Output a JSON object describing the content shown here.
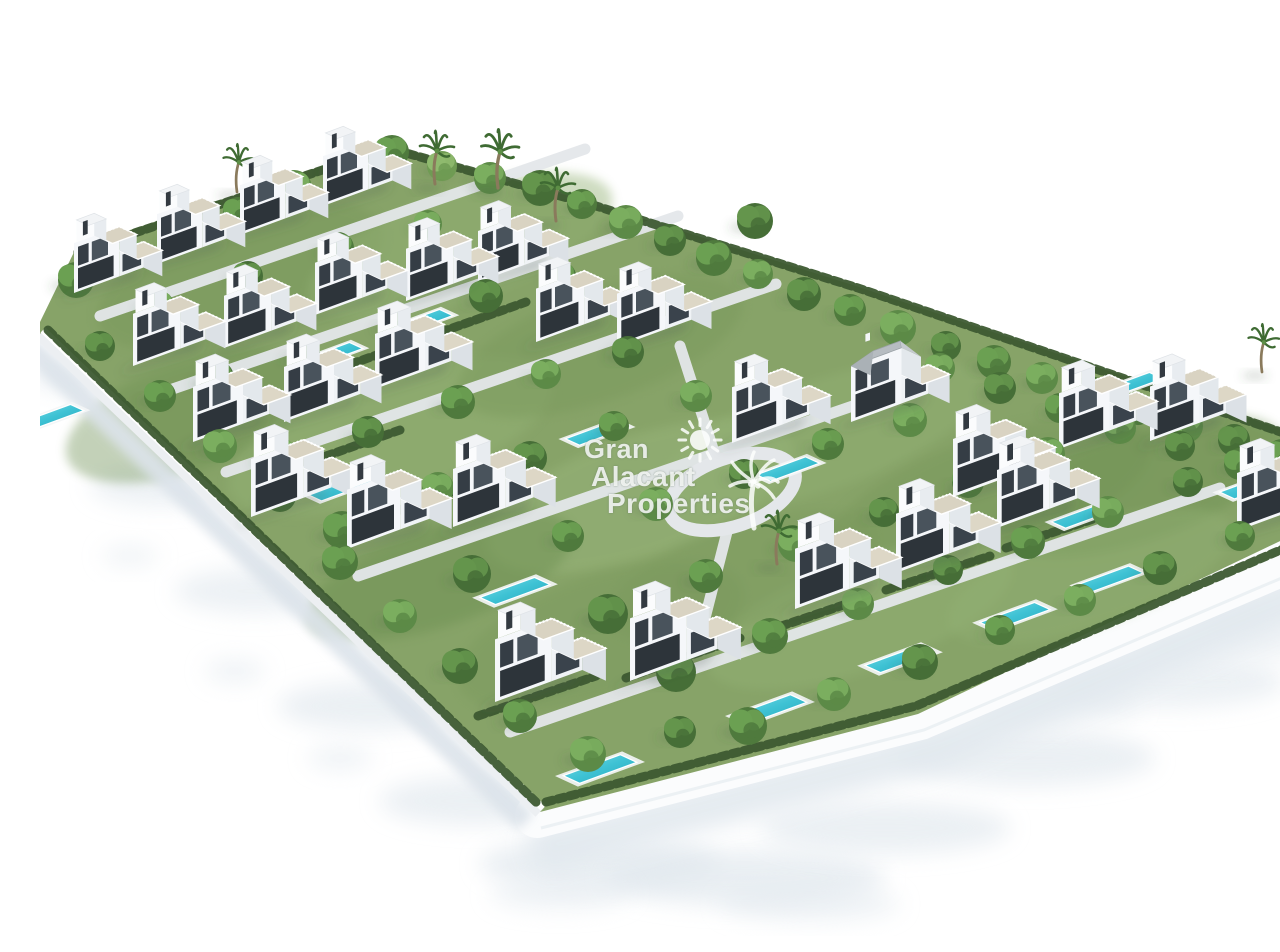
{
  "watermark": {
    "lines": [
      "Gran",
      "Alacant",
      "Properties"
    ],
    "color": "rgba(253,254,253,0.84)",
    "sun_icon": "sun-icon",
    "palm_icon": "palm-tree-icon"
  },
  "scene": {
    "canvas": {
      "w": 1280,
      "h": 920,
      "background": "#ffffff"
    },
    "palette": {
      "grass": "#87a368",
      "grass_patches": [
        "#79985c",
        "#93b174",
        "#6c8f51",
        "#9db97f"
      ],
      "hedge": "#3d5a31",
      "path": "#e4e7ea",
      "wall_top": "#ffffff",
      "wall_face": "#eceff2",
      "road": "#fbfcfd",
      "ground_shadow": "#e1e8ee",
      "villa_front": "#f5f7fa",
      "villa_side": "#dce1e6",
      "terrace": "#d9d3c2",
      "window_dark": "#2d343a",
      "window_glass": "#49535c",
      "pool_water": "#3ec2d4",
      "pool_deep": "#2aa6bb",
      "pool_deck": "#f3f5f6",
      "pitched_roof": "#b6bcc1"
    },
    "parcel": [
      [
        0,
        306
      ],
      [
        36,
        232
      ],
      [
        348,
        128
      ],
      [
        556,
        188
      ],
      [
        816,
        270
      ],
      [
        1280,
        426
      ],
      [
        1280,
        506
      ],
      [
        878,
        698
      ],
      [
        500,
        796
      ],
      [
        0,
        318
      ]
    ],
    "wall_left": [
      [
        0,
        318
      ],
      [
        500,
        796
      ]
    ],
    "road_right": [
      [
        497,
        800
      ],
      [
        880,
        702
      ],
      [
        1280,
        532
      ]
    ],
    "loop_road": {
      "cx": 692,
      "cy": 476,
      "rx": 66,
      "ry": 34,
      "rot": -19
    },
    "paths": [
      [
        [
          60,
          300
        ],
        [
          545,
          133
        ]
      ],
      [
        [
          118,
          378
        ],
        [
          638,
          200
        ]
      ],
      [
        [
          186,
          456
        ],
        [
          736,
          268
        ]
      ],
      [
        [
          318,
          560
        ],
        [
          900,
          360
        ]
      ],
      [
        [
          470,
          716
        ],
        [
          1180,
          472
        ]
      ],
      [
        [
          640,
          330
        ],
        [
          676,
          442
        ]
      ],
      [
        [
          688,
          512
        ],
        [
          664,
          606
        ]
      ]
    ],
    "hedges": [
      [
        [
          8,
          314
        ],
        [
          498,
          788
        ]
      ],
      [
        [
          506,
          786
        ],
        [
          876,
          690
        ],
        [
          1278,
          518
        ]
      ],
      [
        [
          38,
          236
        ],
        [
          348,
          132
        ],
        [
          556,
          190
        ],
        [
          818,
          272
        ],
        [
          1276,
          428
        ]
      ],
      [
        [
          438,
          700
        ],
        [
          556,
          660
        ]
      ],
      [
        [
          586,
          662
        ],
        [
          700,
          622
        ]
      ],
      [
        [
          718,
          618
        ],
        [
          830,
          580
        ]
      ],
      [
        [
          846,
          574
        ],
        [
          950,
          540
        ]
      ],
      [
        [
          966,
          532
        ],
        [
          1068,
          498
        ]
      ],
      [
        [
          252,
          452
        ],
        [
          360,
          414
        ]
      ],
      [
        [
          360,
          494
        ],
        [
          468,
          456
        ]
      ],
      [
        [
          300,
          352
        ],
        [
          396,
          318
        ]
      ],
      [
        [
          390,
          320
        ],
        [
          486,
          286
        ]
      ]
    ],
    "grass_patches": [
      [
        200,
        260,
        150,
        60,
        0,
        0.5
      ],
      [
        420,
        230,
        160,
        55,
        1,
        0.45
      ],
      [
        150,
        400,
        130,
        55,
        2,
        0.4
      ],
      [
        350,
        420,
        170,
        60,
        1,
        0.5
      ],
      [
        560,
        330,
        150,
        55,
        0,
        0.45
      ],
      [
        600,
        480,
        160,
        60,
        3,
        0.4
      ],
      [
        780,
        420,
        170,
        55,
        1,
        0.45
      ],
      [
        950,
        480,
        170,
        60,
        0,
        0.5
      ],
      [
        1100,
        470,
        150,
        55,
        2,
        0.4
      ],
      [
        820,
        600,
        160,
        55,
        1,
        0.45
      ],
      [
        560,
        620,
        150,
        60,
        0,
        0.4
      ],
      [
        400,
        560,
        140,
        50,
        2,
        0.45
      ],
      [
        1050,
        560,
        150,
        50,
        1,
        0.4
      ],
      [
        700,
        560,
        140,
        50,
        0,
        0.35
      ]
    ],
    "ground_shadows": [
      [
        40,
        360,
        52,
        16,
        0.6
      ],
      [
        120,
        470,
        70,
        20,
        0.6
      ],
      [
        215,
        575,
        80,
        22,
        0.6
      ],
      [
        330,
        690,
        92,
        24,
        0.65
      ],
      [
        435,
        785,
        95,
        24,
        0.65
      ],
      [
        560,
        848,
        120,
        26,
        0.7
      ],
      [
        705,
        862,
        140,
        28,
        0.7
      ],
      [
        845,
        812,
        125,
        26,
        0.65
      ],
      [
        985,
        742,
        130,
        28,
        0.65
      ],
      [
        1125,
        666,
        120,
        26,
        0.6
      ],
      [
        1245,
        602,
        100,
        22,
        0.55
      ],
      [
        520,
        878,
        70,
        16,
        0.5
      ],
      [
        770,
        888,
        90,
        18,
        0.5
      ],
      [
        90,
        540,
        28,
        10,
        0.5
      ],
      [
        195,
        655,
        30,
        12,
        0.5
      ],
      [
        300,
        742,
        32,
        12,
        0.5
      ],
      [
        1010,
        690,
        90,
        20,
        0.5
      ],
      [
        1180,
        630,
        80,
        18,
        0.5
      ]
    ],
    "villas": [
      [
        34,
        277,
        0.86,
        "n"
      ],
      [
        117,
        248,
        0.86,
        "n"
      ],
      [
        200,
        219,
        0.86,
        "n"
      ],
      [
        283,
        190,
        0.86,
        "n"
      ],
      [
        438,
        266,
        0.88,
        "n"
      ],
      [
        93,
        350,
        0.9,
        "n"
      ],
      [
        184,
        332,
        0.9,
        "n"
      ],
      [
        275,
        299,
        0.9,
        "n"
      ],
      [
        366,
        285,
        0.9,
        "n"
      ],
      [
        496,
        326,
        0.92,
        "n"
      ],
      [
        153,
        426,
        0.95,
        "n"
      ],
      [
        244,
        406,
        0.95,
        "n"
      ],
      [
        335,
        373,
        0.95,
        "n"
      ],
      [
        211,
        501,
        1.0,
        "n"
      ],
      [
        307,
        533,
        1.02,
        "n"
      ],
      [
        413,
        511,
        1.0,
        "n"
      ],
      [
        577,
        331,
        0.92,
        "n"
      ],
      [
        692,
        427,
        0.96,
        "n"
      ],
      [
        811,
        406,
        0.96,
        "p"
      ],
      [
        913,
        481,
        1.0,
        "n"
      ],
      [
        1019,
        433,
        0.96,
        "n"
      ],
      [
        1110,
        425,
        0.94,
        "n"
      ],
      [
        1197,
        515,
        1.0,
        "n"
      ],
      [
        455,
        686,
        1.08,
        "n"
      ],
      [
        590,
        665,
        1.08,
        "n"
      ],
      [
        755,
        593,
        1.04,
        "n"
      ],
      [
        856,
        557,
        1.02,
        "n"
      ],
      [
        957,
        512,
        1.0,
        "n"
      ]
    ],
    "pools": [
      [
        293,
        338,
        0.85
      ],
      [
        383,
        305,
        0.85
      ],
      [
        300,
        472,
        0.95
      ],
      [
        475,
        575,
        1
      ],
      [
        560,
        753,
        1.05
      ],
      [
        730,
        693,
        1.05
      ],
      [
        860,
        643,
        1
      ],
      [
        975,
        600,
        1
      ],
      [
        1070,
        563,
        0.95
      ],
      [
        1213,
        470,
        0.95
      ],
      [
        1043,
        500,
        0.9
      ],
      [
        748,
        453,
        0.9
      ],
      [
        557,
        417,
        0.9
      ],
      [
        14,
        400,
        0.85
      ],
      [
        950,
        432,
        0.85
      ],
      [
        1093,
        368,
        0.85
      ]
    ],
    "trees": [
      [
        36,
        264,
        18,
        0
      ],
      [
        90,
        240,
        16,
        1
      ],
      [
        142,
        218,
        17,
        2
      ],
      [
        198,
        196,
        15,
        0
      ],
      [
        254,
        172,
        18,
        1
      ],
      [
        302,
        152,
        16,
        2
      ],
      [
        352,
        136,
        17,
        0
      ],
      [
        402,
        150,
        15,
        3
      ],
      [
        450,
        162,
        16,
        1
      ],
      [
        500,
        172,
        18,
        2
      ],
      [
        542,
        188,
        15,
        0
      ],
      [
        586,
        206,
        17,
        1
      ],
      [
        630,
        224,
        16,
        2
      ],
      [
        674,
        242,
        18,
        0
      ],
      [
        718,
        258,
        15,
        1
      ],
      [
        764,
        278,
        17,
        2
      ],
      [
        810,
        294,
        16,
        0
      ],
      [
        858,
        312,
        18,
        1
      ],
      [
        906,
        330,
        15,
        2
      ],
      [
        954,
        346,
        17,
        0
      ],
      [
        1002,
        362,
        16,
        1
      ],
      [
        1050,
        378,
        18,
        2
      ],
      [
        1098,
        394,
        15,
        0
      ],
      [
        1146,
        410,
        17,
        1
      ],
      [
        1194,
        424,
        16,
        2
      ],
      [
        1242,
        440,
        17,
        0
      ],
      [
        118,
        290,
        16,
        1
      ],
      [
        208,
        260,
        15,
        2
      ],
      [
        298,
        232,
        16,
        0
      ],
      [
        388,
        208,
        14,
        1
      ],
      [
        176,
        362,
        18,
        2
      ],
      [
        264,
        338,
        16,
        0
      ],
      [
        354,
        308,
        15,
        1
      ],
      [
        446,
        280,
        17,
        2
      ],
      [
        522,
        260,
        14,
        0
      ],
      [
        238,
        440,
        19,
        1
      ],
      [
        328,
        416,
        16,
        2
      ],
      [
        418,
        386,
        17,
        0
      ],
      [
        506,
        358,
        15,
        1
      ],
      [
        588,
        336,
        16,
        2
      ],
      [
        302,
        514,
        19,
        0
      ],
      [
        398,
        472,
        16,
        1
      ],
      [
        490,
        442,
        17,
        2
      ],
      [
        574,
        410,
        15,
        0
      ],
      [
        656,
        380,
        16,
        1
      ],
      [
        432,
        558,
        19,
        2
      ],
      [
        528,
        520,
        16,
        0
      ],
      [
        616,
        488,
        17,
        1
      ],
      [
        704,
        458,
        15,
        2
      ],
      [
        788,
        428,
        16,
        0
      ],
      [
        870,
        404,
        17,
        1
      ],
      [
        568,
        598,
        20,
        2
      ],
      [
        666,
        560,
        17,
        0
      ],
      [
        756,
        528,
        18,
        1
      ],
      [
        844,
        496,
        15,
        2
      ],
      [
        928,
        466,
        16,
        0
      ],
      [
        1008,
        438,
        17,
        1
      ],
      [
        636,
        656,
        20,
        2
      ],
      [
        730,
        620,
        18,
        0
      ],
      [
        818,
        588,
        16,
        1
      ],
      [
        908,
        554,
        15,
        2
      ],
      [
        988,
        526,
        17,
        0
      ],
      [
        1068,
        496,
        16,
        1
      ],
      [
        1148,
        466,
        15,
        2
      ],
      [
        708,
        710,
        19,
        0
      ],
      [
        794,
        678,
        17,
        1
      ],
      [
        880,
        646,
        18,
        2
      ],
      [
        960,
        614,
        15,
        0
      ],
      [
        1040,
        584,
        16,
        1
      ],
      [
        1120,
        552,
        17,
        2
      ],
      [
        1200,
        520,
        15,
        0
      ],
      [
        60,
        330,
        15,
        2
      ],
      [
        120,
        380,
        16,
        0
      ],
      [
        180,
        430,
        17,
        1
      ],
      [
        240,
        480,
        16,
        2
      ],
      [
        300,
        546,
        18,
        0
      ],
      [
        360,
        600,
        17,
        1
      ],
      [
        420,
        650,
        18,
        2
      ],
      [
        480,
        700,
        17,
        0
      ],
      [
        548,
        738,
        18,
        1
      ],
      [
        640,
        716,
        16,
        2
      ],
      [
        900,
        352,
        15,
        1
      ],
      [
        960,
        372,
        16,
        2
      ],
      [
        1020,
        392,
        15,
        0
      ],
      [
        1080,
        412,
        16,
        1
      ],
      [
        1140,
        430,
        15,
        2
      ],
      [
        1200,
        448,
        16,
        0
      ],
      [
        1252,
        464,
        15,
        1
      ],
      [
        715,
        205,
        18,
        2
      ]
    ],
    "palms": [
      [
        197,
        176,
        0.9
      ],
      [
        395,
        168,
        1.0
      ],
      [
        458,
        172,
        1.1
      ],
      [
        516,
        205,
        1.0
      ],
      [
        737,
        548,
        1.0
      ],
      [
        1222,
        356,
        0.9
      ]
    ],
    "tree_greens": [
      [
        "#4f7a3d",
        "#6ba052"
      ],
      [
        "#5c8a47",
        "#7bae5f"
      ],
      [
        "#466e37",
        "#64954c"
      ],
      [
        "#6f9b53",
        "#8fba6e"
      ]
    ]
  }
}
